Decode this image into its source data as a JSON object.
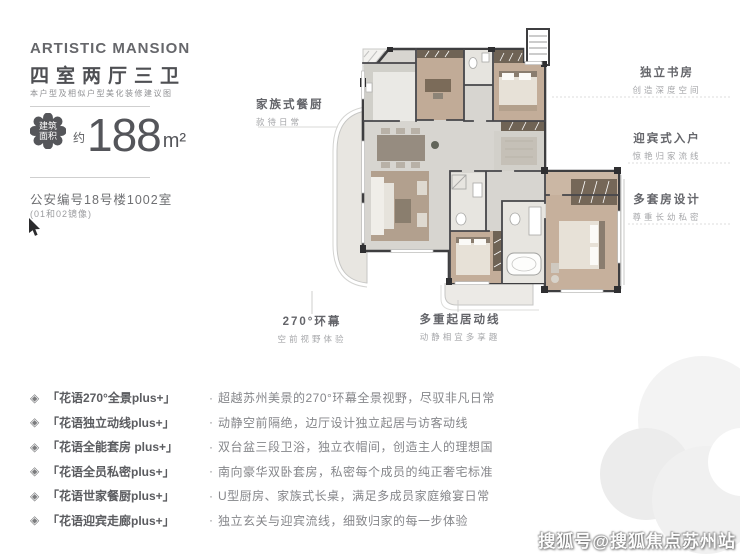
{
  "header": {
    "brand": "ARTISTIC MANSION",
    "layout_title": "四室两厅三卫",
    "disclaimer": "本户型及相似户型美化装修建议图",
    "area": {
      "badge": "建筑面积",
      "approx": "约",
      "value": "188",
      "unit": "m²"
    },
    "police_no": "公安编号18号楼1002室",
    "mirror_note": "(01和02镜像)"
  },
  "plan": {
    "annotations": {
      "family_kitchen": {
        "title": "家族式餐厨",
        "sub": "款待日常"
      },
      "study": {
        "title": "独立书房",
        "sub": "创造深度空间"
      },
      "entry": {
        "title": "迎宾式入户",
        "sub": "惊艳归家流线"
      },
      "multi_suite": {
        "title": "多套房设计",
        "sub": "尊重长幼私密"
      },
      "panorama": {
        "title": "270°环幕",
        "sub": "空前视野体验"
      },
      "living_lines": {
        "title": "多重起居动线",
        "sub": "动静相宜多享趣"
      }
    }
  },
  "features": {
    "icon": "◈",
    "sep": "·",
    "items": [
      {
        "name": "「花语270°全景plus+」",
        "desc": "超越苏州美景的270°环幕全景视野，尽驭非凡日常"
      },
      {
        "name": "「花语独立动线plus+」",
        "desc": "动静空前隔绝，边厅设计独立起居与访客动线"
      },
      {
        "name": "「花语全能套房 plus+」",
        "desc": "双台盆三段卫浴，独立衣帽间，创造主人的理想国"
      },
      {
        "name": "「花语全员私密plus+」",
        "desc": "南向豪华双卧套房，私密每个成员的纯正奢宅标准"
      },
      {
        "name": "「花语世家餐厨plus+」",
        "desc": "U型厨房、家族式长桌，满足多成员家庭飨宴日常"
      },
      {
        "name": "「花语迎宾走廊plus+」",
        "desc": "独立玄关与迎宾流线，细致归家的每一步体验"
      }
    ]
  },
  "watermark": "搜狐号@搜狐焦点苏州站",
  "colors": {
    "ink": "#4e4f53",
    "grey_text": "#85868a",
    "badge": "#55565a",
    "wall": "#3e3e40",
    "floor_grey": "#d7d5d0",
    "floor_tan": "#c3ad99",
    "accent_wood": "#6f6355"
  }
}
